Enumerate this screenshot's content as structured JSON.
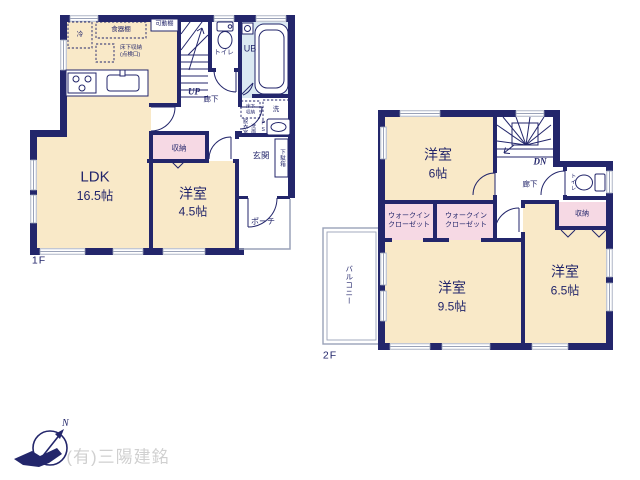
{
  "meta": {
    "title": "間取り図",
    "width": 640,
    "height": 480
  },
  "colors": {
    "wall": "#23266b",
    "room": "#f9e9c8",
    "closet": "#f6d9e4",
    "bath": "#dbe9f2",
    "window": "#9aa2b8",
    "footer_text": "#d0d0d0"
  },
  "f1": {
    "floor_label": "1F",
    "ldk_name": "LDK",
    "ldk_size": "16.5帖",
    "yoshitsu_name": "洋室",
    "yoshitsu_size": "4.5帖",
    "fridge": "冷",
    "cupboard": "食器棚",
    "movable_shelf": "可動棚",
    "underfloor_storage": "床下収納\n(点検口)",
    "toilet": "トイレ",
    "unit_bath": "UB",
    "stairs": "UP",
    "hallway": "廊下",
    "laundry": "洗",
    "underfloor_small": "床下\n収納",
    "dressing_room": "脱衣室",
    "washbasin": "洗面",
    "pipe_space": "PS",
    "storage": "収納",
    "shoe_cabinet": "下駄箱",
    "entrance": "玄関",
    "porch": "ポーチ"
  },
  "f2": {
    "floor_label": "2F",
    "yo6_name": "洋室",
    "yo6_size": "6帖",
    "yo95_name": "洋室",
    "yo95_size": "9.5帖",
    "yo65_name": "洋室",
    "yo65_size": "6.5帖",
    "wic1": "ウォークイン\nクローゼット",
    "wic2": "ウォークイン\nクローゼット",
    "stairs": "DN",
    "hallway": "廊下",
    "toilet": "トイレ",
    "storage": "収納",
    "balcony": "バルコニー"
  },
  "footer": {
    "company": "(有)三陽建銘",
    "north": "N"
  }
}
